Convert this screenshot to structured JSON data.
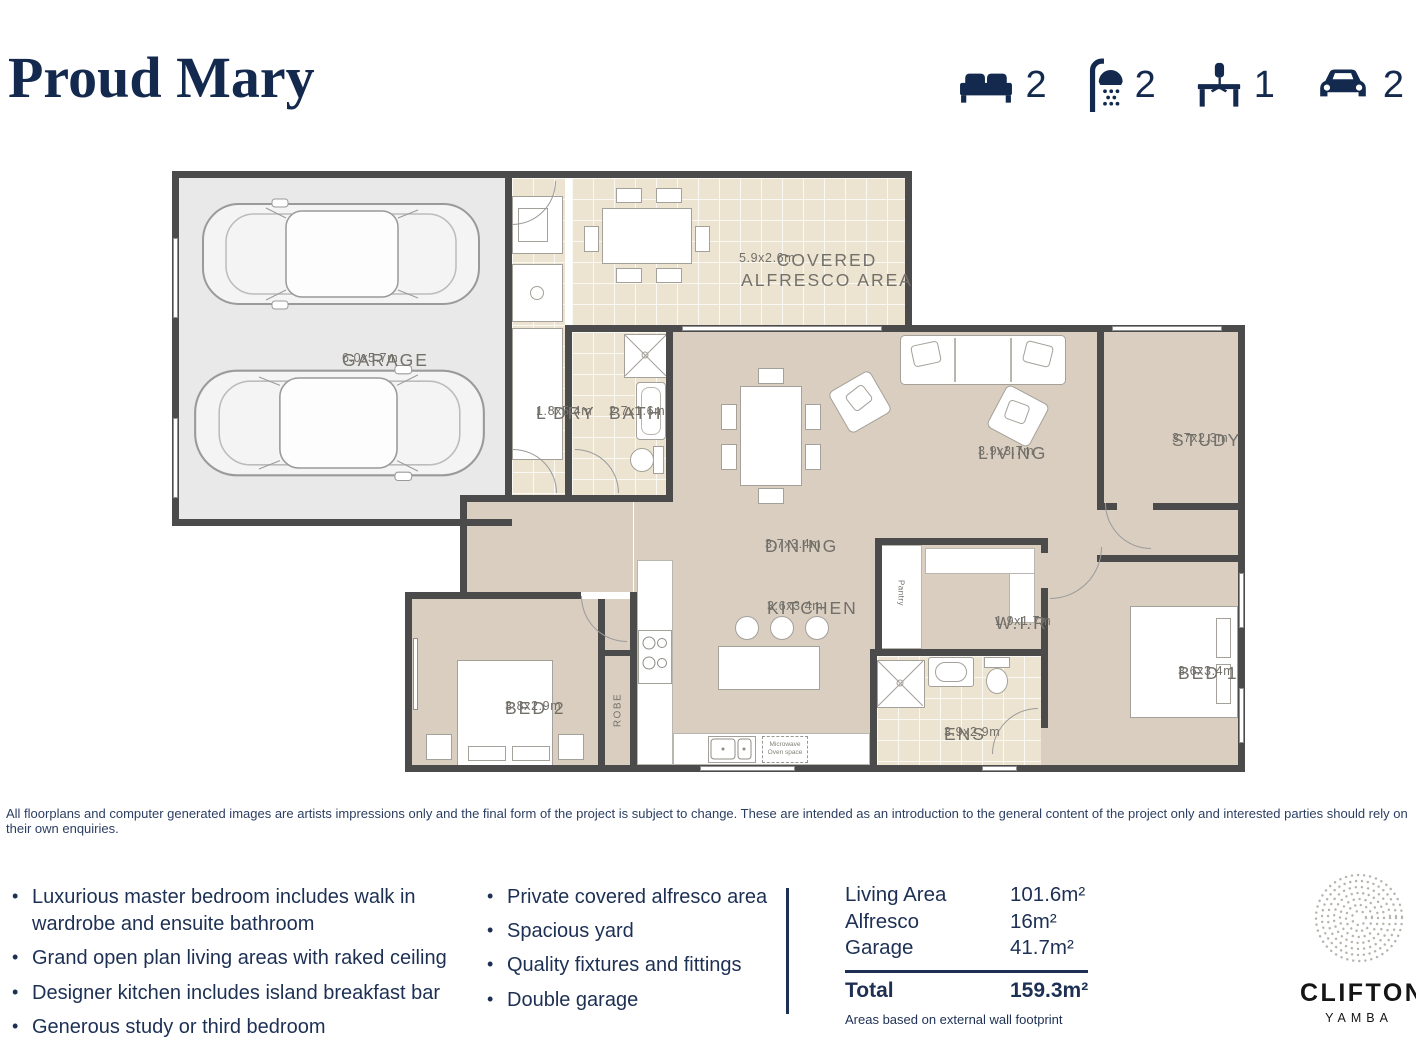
{
  "header": {
    "title": "Proud Mary",
    "stats": {
      "beds": "2",
      "showers": "2",
      "study": "1",
      "cars": "2"
    }
  },
  "floorplan": {
    "rooms": [
      {
        "name": "GARAGE",
        "dims": "6.0x5.7m"
      },
      {
        "name": "L'DRY",
        "dims": "1.8x5.4m"
      },
      {
        "name": "COVERED ALFRESCO AREA",
        "dims": "5.9x2.6m"
      },
      {
        "name": "BATH",
        "dims": "2.7x1.6m"
      },
      {
        "name": "LIVING",
        "dims": "3.9x3.7m"
      },
      {
        "name": "DINING",
        "dims": "3.7x3.4m"
      },
      {
        "name": "STUDY",
        "dims": "3.7x2.3m"
      },
      {
        "name": "KITCHEN",
        "dims": "3.6x3.4m"
      },
      {
        "name": "W.I.R",
        "dims": "1.9x1.7m"
      },
      {
        "name": "BED 1",
        "dims": "3.6x3.4m"
      },
      {
        "name": "BED 2",
        "dims": "3.8x2.9m"
      },
      {
        "name": "ENS",
        "dims": "3.9x2.9m"
      }
    ],
    "annotations": {
      "robe": "ROBE",
      "pantry": "Pantry",
      "microwave": "Microwave Oven space"
    }
  },
  "disclaimer": "All floorplans and computer generated images are artists impressions only and the final form of the project is subject to change. These are intended as an introduction to the general content of the project only and interested parties should rely on their own enquiries.",
  "features": {
    "col1": [
      "Luxurious master bedroom includes walk in wardrobe and ensuite bathroom",
      "Grand open plan living areas with raked ceiling",
      "Designer kitchen includes island breakfast bar",
      "Generous study or third bedroom"
    ],
    "col2": [
      "Private covered alfresco area",
      "Spacious yard",
      "Quality fixtures and fittings",
      "Double garage"
    ]
  },
  "areas": {
    "rows": [
      {
        "label": "Living Area",
        "value": "101.6m²"
      },
      {
        "label": "Alfresco",
        "value": "16m²"
      },
      {
        "label": "Garage",
        "value": "41.7m²"
      }
    ],
    "total_label": "Total",
    "total_value": "159.3m²",
    "footnote": "Areas based on external wall footprint"
  },
  "logo": {
    "name": "CLIFTON",
    "location": "YAMBA"
  },
  "colors": {
    "accent_navy": "#14294e",
    "floor": "#d9cec0",
    "tile": "#ece4d1",
    "wall": "#4b4b4b"
  }
}
